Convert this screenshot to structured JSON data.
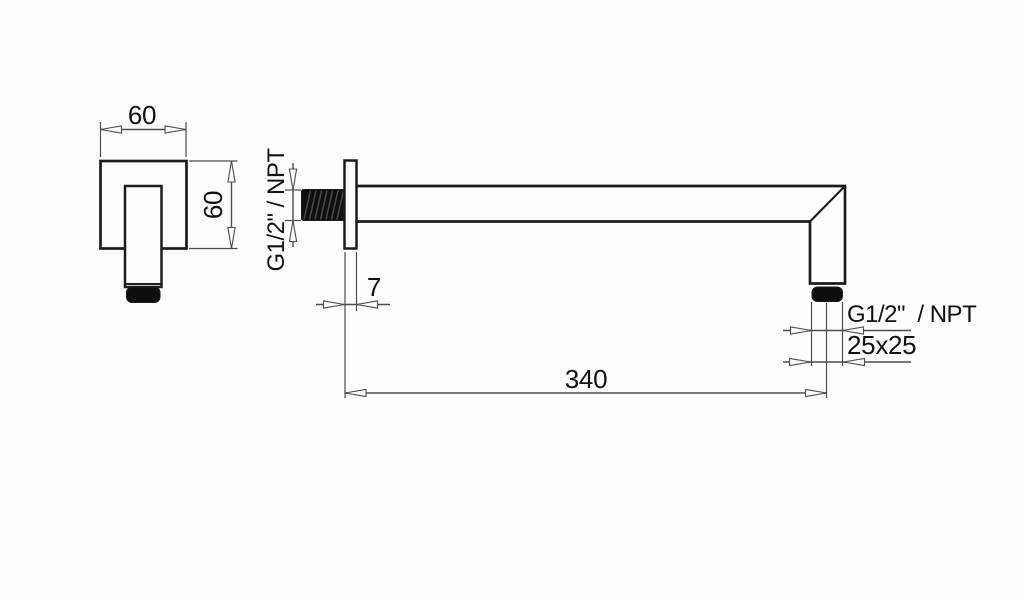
{
  "colors": {
    "background": "#fdfdfd",
    "object-line": "#1c1c1c",
    "dim-line": "#4d4d4d",
    "text-color": "#111111",
    "fill-dark": "#0e0e0e"
  },
  "front_view": {
    "width_label": "60",
    "height_label": "60"
  },
  "side_view": {
    "wall_thread_label": "G1/2\" / NPT",
    "plate_thickness_label": "7",
    "arm_length_label": "340",
    "outlet_thread_label": "G1/2\"  / NPT",
    "outlet_size_label": "25x25"
  }
}
